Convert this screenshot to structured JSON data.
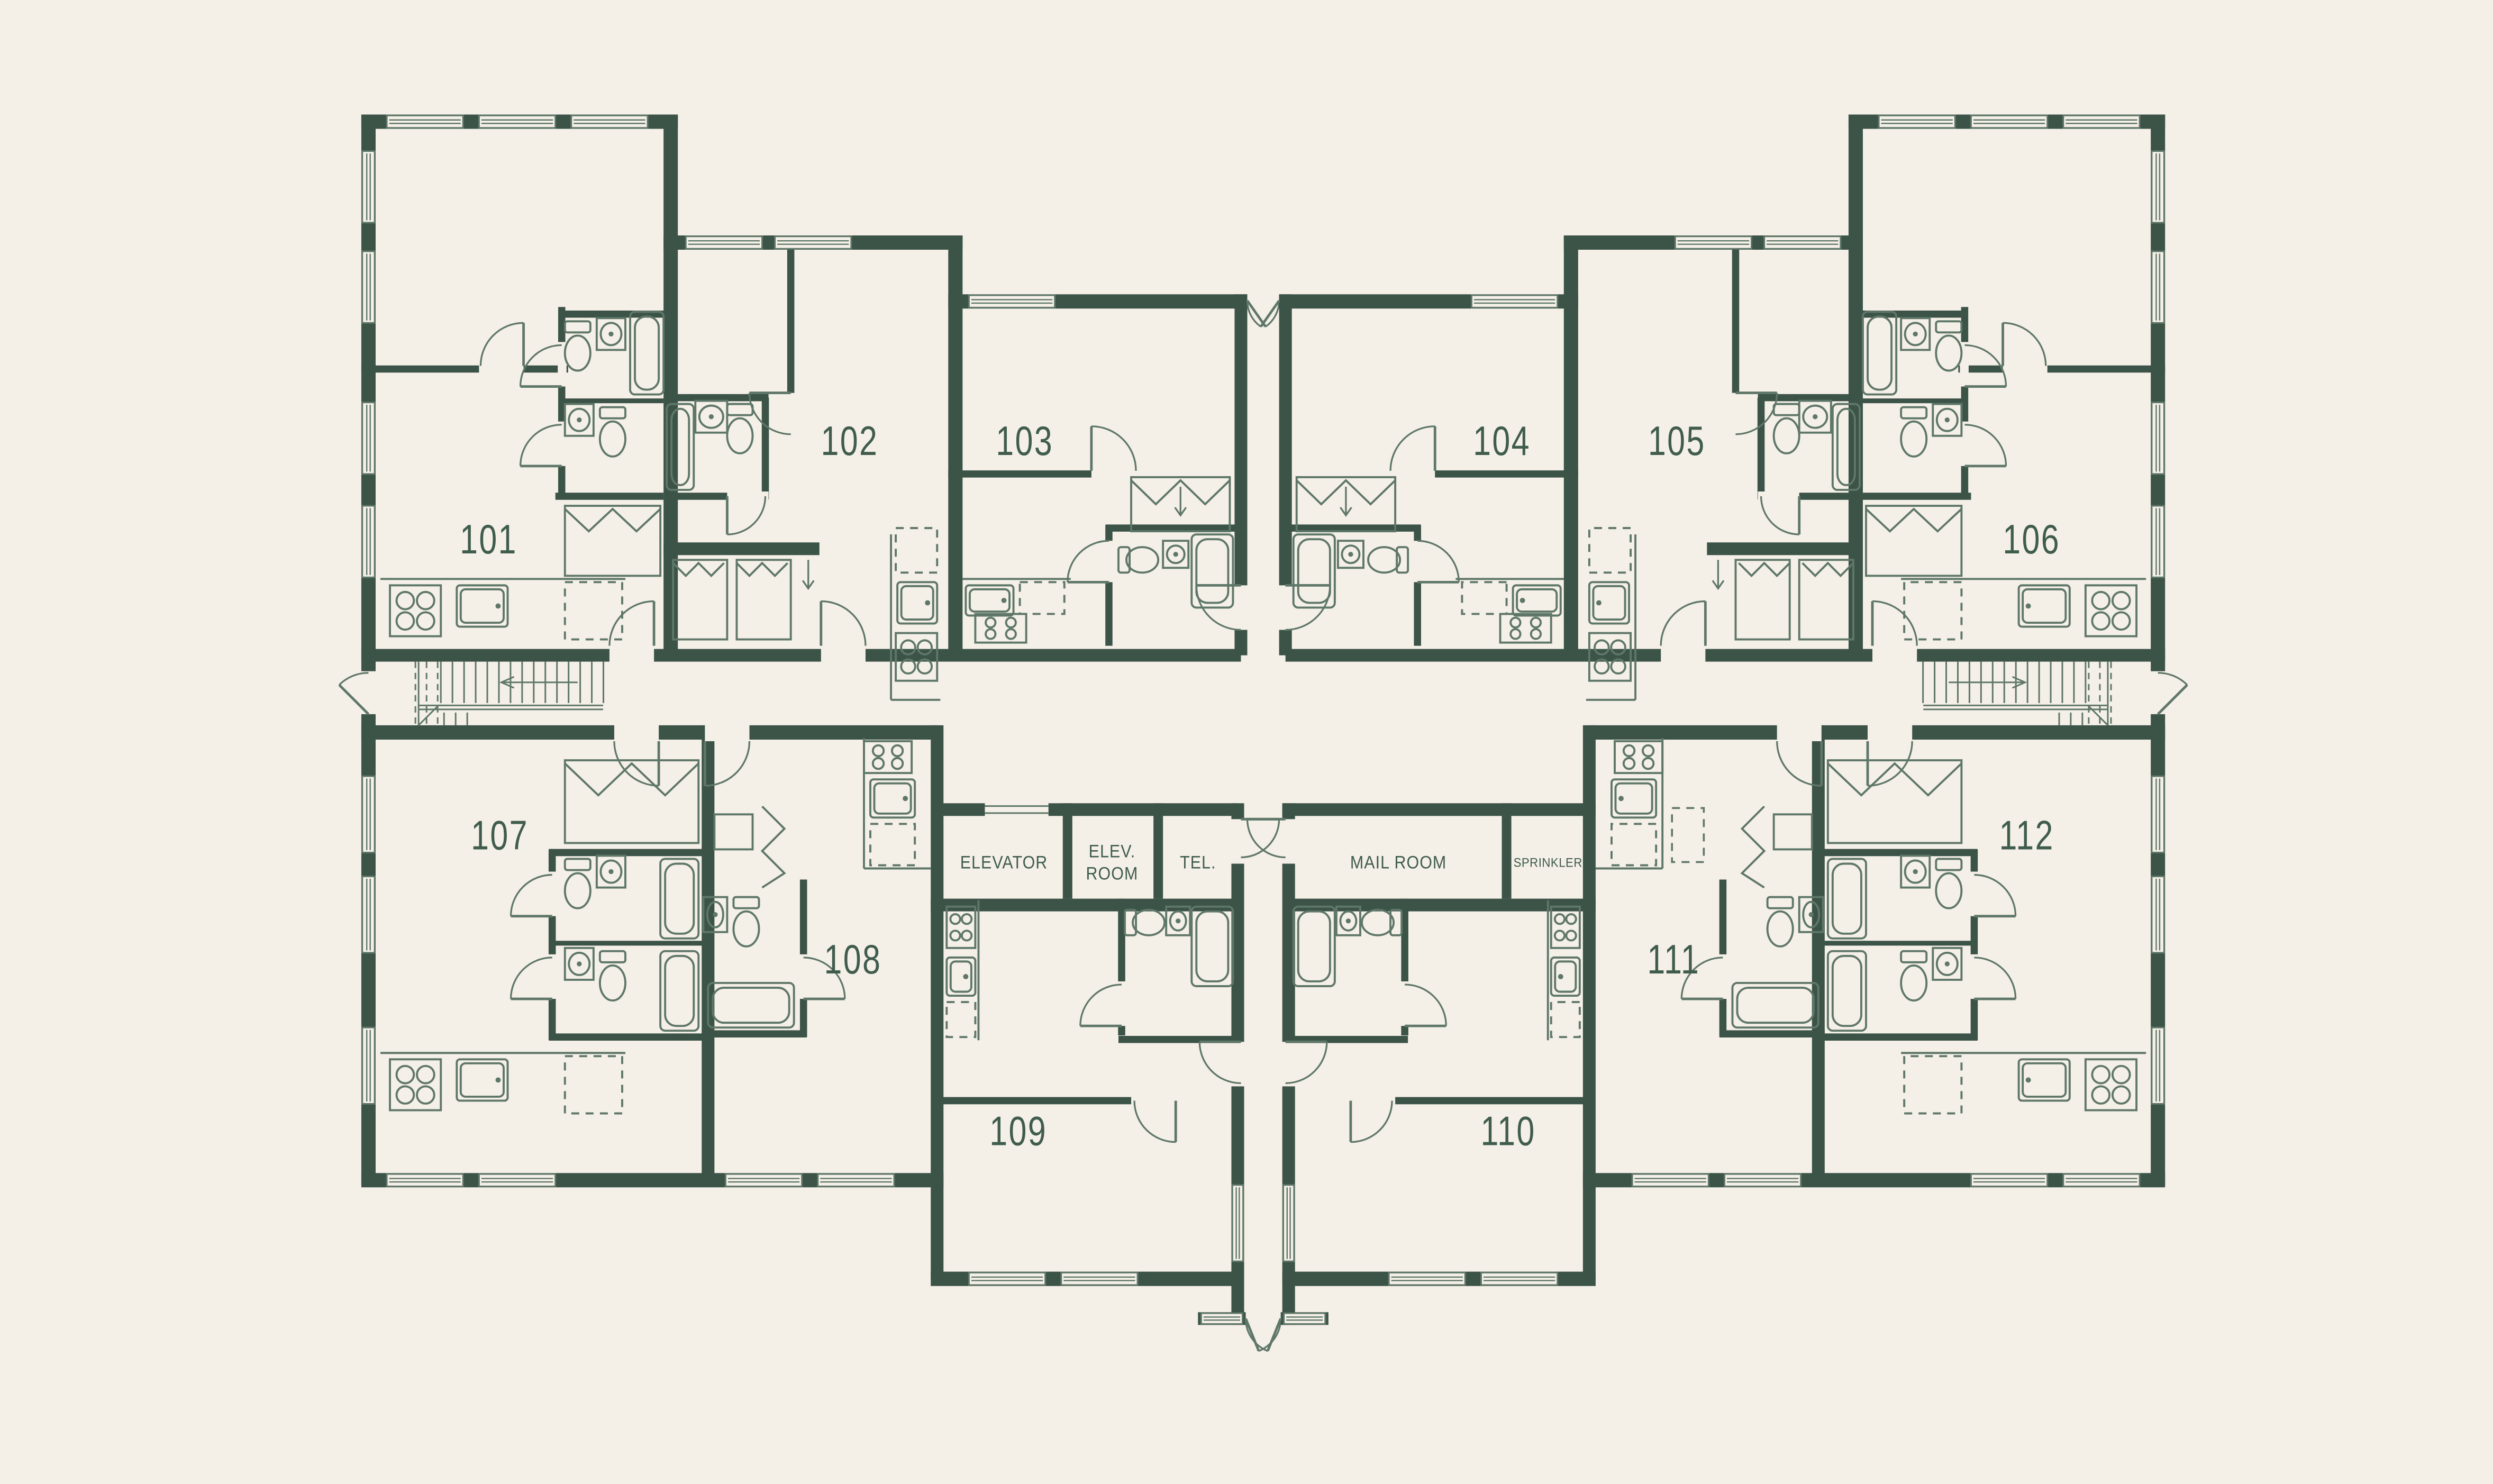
{
  "colors": {
    "background": "#f5f0e7",
    "wall": "#3c5348",
    "line": "#5f7769",
    "label": "#3f5c4d"
  },
  "units": [
    {
      "number": "101"
    },
    {
      "number": "102"
    },
    {
      "number": "103"
    },
    {
      "number": "104"
    },
    {
      "number": "105"
    },
    {
      "number": "106"
    },
    {
      "number": "107"
    },
    {
      "number": "108"
    },
    {
      "number": "109"
    },
    {
      "number": "110"
    },
    {
      "number": "111"
    },
    {
      "number": "112"
    }
  ],
  "service_rooms": {
    "elevator": "ELEVATOR",
    "elev_room_line1": "ELEV.",
    "elev_room_line2": "ROOM",
    "tel": "TEL.",
    "mail_room": "MAIL ROOM",
    "sprinkler": "SPRINKLER"
  }
}
